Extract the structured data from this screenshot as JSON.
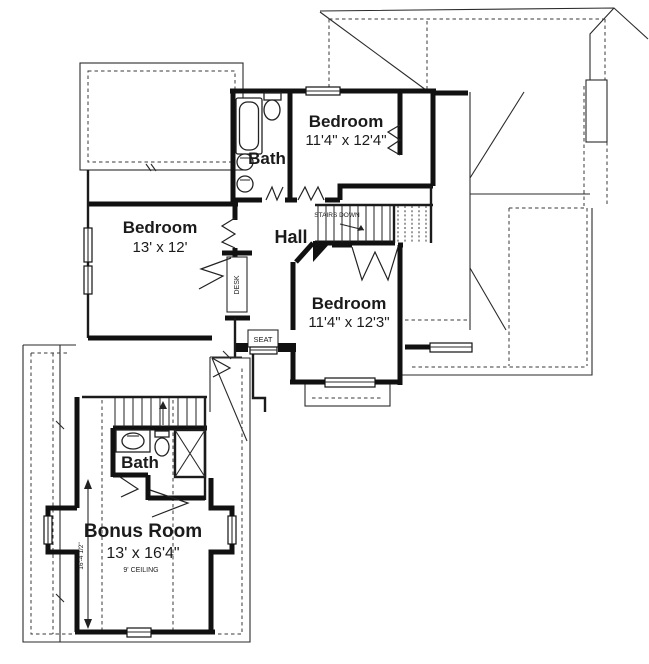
{
  "colors": {
    "line": "#1b1b1b",
    "background": "#ffffff"
  },
  "rooms": {
    "bedroom_top": {
      "name": "Bedroom",
      "dims": "11'4\" x 12'4\""
    },
    "bedroom_left": {
      "name": "Bedroom",
      "dims": "13' x 12'"
    },
    "bedroom_middle": {
      "name": "Bedroom",
      "dims": "11'4\" x 12'3\""
    },
    "hall": {
      "name": "Hall"
    },
    "bath_upper": {
      "name": "Bath"
    },
    "bath_lower": {
      "name": "Bath"
    },
    "bonus_room": {
      "name": "Bonus Room",
      "dims": "13' x 16'4\"",
      "ceiling_note": "9' CEILING"
    }
  },
  "annotations": {
    "stairs_down": "STAIRS DOWN",
    "desk": "DESK",
    "seat": "SEAT",
    "vertical_dimension": "16'-4 1/2\""
  }
}
